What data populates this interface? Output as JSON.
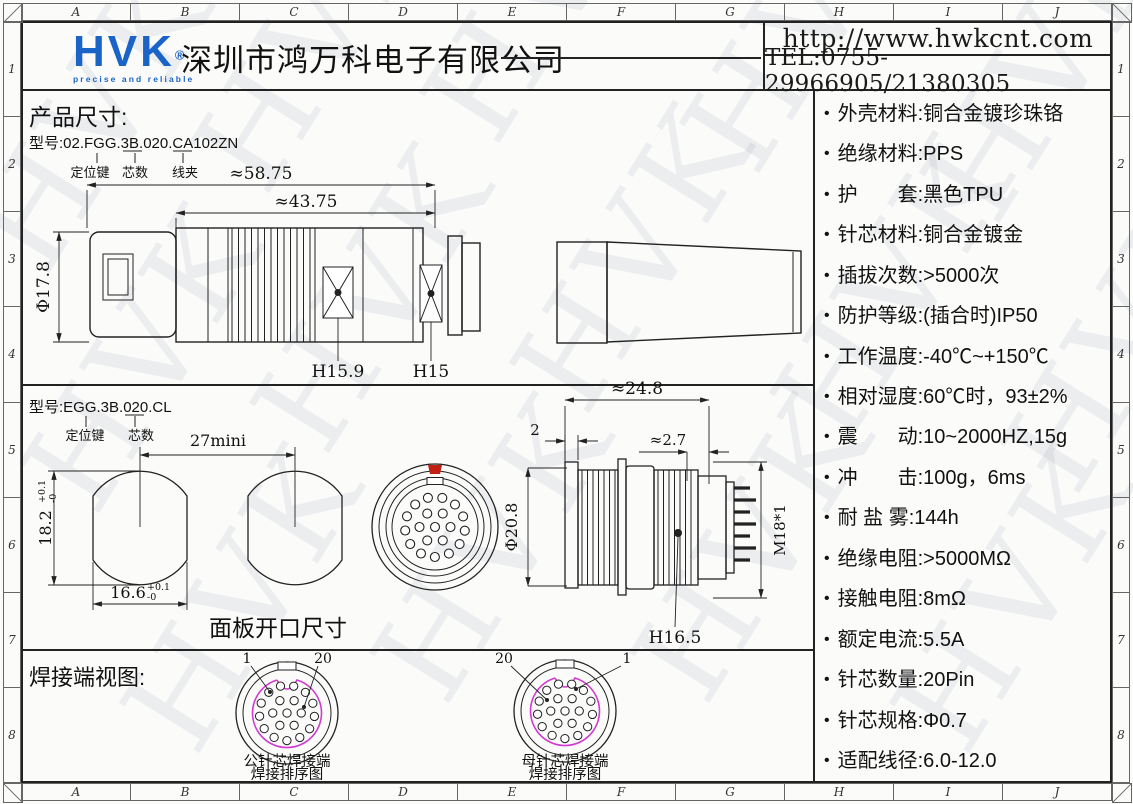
{
  "watermark": "HVK",
  "frame": {
    "letters": [
      "A",
      "B",
      "C",
      "D",
      "E",
      "F",
      "G",
      "H",
      "I",
      "J"
    ],
    "numbers": [
      "1",
      "2",
      "3",
      "4",
      "5",
      "6",
      "7",
      "8"
    ]
  },
  "header": {
    "logo": "HVK",
    "registered": "®",
    "tagline": "precise and reliable",
    "company": "深圳市鸿万科电子有限公司",
    "url": "http://www.hwkcnt.com",
    "tel": "TEL:0755-29966905/21380305"
  },
  "section1": {
    "title": "产品尺寸:",
    "model": "型号:02.FGG.3B.020.CA102ZN",
    "callout_keying": "定位键",
    "callout_pins": "芯数",
    "callout_clamp": "线夹",
    "dim_total": "≈58.75",
    "dim_body": "≈43.75",
    "dim_dia": "Φ17.8",
    "dim_hex1": "H15.9",
    "dim_hex2": "H15"
  },
  "section2": {
    "model": "型号:EGG.3B.020.CL",
    "callout_keying": "定位键",
    "callout_pins": "芯数",
    "dim_spacing": "27mini",
    "dim_height": "18.2",
    "tol_plus": "+0.1",
    "tol_minus": "-0",
    "dim_width": "16.6",
    "panel_label": "面板开口尺寸",
    "dim_flange": "2",
    "dim_length": "≈24.8",
    "dim_back": "≈2.7",
    "dim_dia": "Φ20.8",
    "dim_thread": "M18*1",
    "dim_hex": "H16.5"
  },
  "section3": {
    "title": "焊接端视图:",
    "male": {
      "pin_first": "1",
      "pin_last": "20",
      "caption1": "公针芯焊接端",
      "caption2": "焊接排序图"
    },
    "female": {
      "pin_first": "20",
      "pin_last": "1",
      "caption1": "母针芯焊接端",
      "caption2": "焊接排序图"
    }
  },
  "specs": {
    "items": [
      "外壳材料:铜合金镀珍珠铬",
      "绝缘材料:PPS",
      "护　　套:黑色TPU",
      "针芯材料:铜合金镀金",
      "插拔次数:>5000次",
      "防护等级:(插合时)IP50",
      "工作温度:-40℃~+150℃",
      "相对湿度:60℃时，93±2%",
      "震　　动:10~2000HZ,15g",
      "冲　　击:100g，6ms",
      "耐 盐 雾:144h",
      "绝缘电阻:>5000MΩ",
      "接触电阻:8mΩ",
      "额定电流:5.5A",
      "针芯数量:20Pin",
      "针芯规格:Φ0.7",
      "适配线径:6.0-12.0"
    ]
  },
  "colors": {
    "logo_blue": "#1a64c8",
    "accent_red": "#c22012",
    "pin_magenta": "#d23ad2",
    "line": "#222222"
  }
}
